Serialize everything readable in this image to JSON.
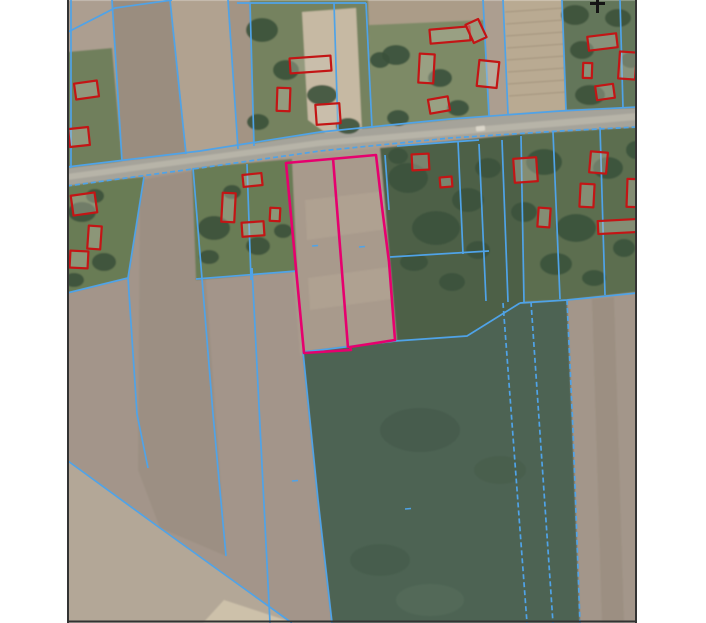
{
  "app": {
    "name": "cadastral-aerial-map-view"
  },
  "canvas": {
    "width": 706,
    "height": 623,
    "margin_color": "#ffffff"
  },
  "map": {
    "x": 67,
    "y": 0,
    "width": 570,
    "height": 623,
    "border_color": "#333333",
    "border_width": 2,
    "base_fill": "#ac9e90"
  },
  "legend_colors": {
    "parcel_boundary": "#4fa3e8",
    "building_outline": "#c31515",
    "selected_parcel": "#e6006e",
    "road": "#a5a39a",
    "north_mark": "#141414"
  },
  "fields": [
    {
      "name": "upper-left-green",
      "points": "67,52 112,48 122,161 67,170",
      "fill": "#6f7f5c"
    },
    {
      "name": "upper-strip-1",
      "points": "112,0 170,0 186,154 122,161",
      "fill": "#9a8d7f"
    },
    {
      "name": "upper-strip-2",
      "points": "170,0 228,0 238,149 186,154",
      "fill": "#b1a290"
    },
    {
      "name": "upper-strip-3",
      "points": "228,0 250,0 254,147 238,149",
      "fill": "#a39484"
    },
    {
      "name": "farmstead-1-green",
      "points": "250,0 368,0 372,128 254,147",
      "fill": "#75825f"
    },
    {
      "name": "farmstead-1-yard",
      "points": "302,12 356,8 362,132 330,136 308,120",
      "fill": "#c6b9a3"
    },
    {
      "name": "farmstead-2-green",
      "points": "368,0 483,0 489,116 372,128",
      "fill": "#7d8a66"
    },
    {
      "name": "farmstead-2-top-strip",
      "points": "368,0 483,0 484,20 369,25",
      "fill": "#ab9c88"
    },
    {
      "name": "rowed-garden",
      "points": "503,0 562,0 566,110 508,114",
      "fill": "#b9aa92"
    },
    {
      "name": "right-green-top",
      "points": "562,0 637,0 637,108 566,110",
      "fill": "#64765a"
    },
    {
      "name": "below-road-left-brown",
      "points": "67,186 300,156 335,623 67,623",
      "fill": "#a3958a"
    },
    {
      "name": "below-road-strip",
      "points": "140,180 198,170 226,556 160,528 138,470",
      "fill": "#9b8e81",
      "opacity": 0.85
    },
    {
      "name": "mid-brown-field",
      "points": "283,158 400,146 406,345 300,356",
      "fill": "#a89a8c"
    },
    {
      "name": "mid-field-strip-1",
      "points": "305,200 394,190 395,228 307,240",
      "fill": "#b5a795",
      "opacity": 0.55
    },
    {
      "name": "mid-field-strip-2",
      "points": "308,278 397,266 399,298 310,310",
      "fill": "#b5a795",
      "opacity": 0.5
    },
    {
      "name": "homestead-a-green",
      "points": "67,184 144,177 128,278 67,293",
      "fill": "#697b55"
    },
    {
      "name": "homestead-b-green",
      "points": "192,168 292,159 297,271 196,280",
      "fill": "#697b55"
    },
    {
      "name": "gardens-dark-green",
      "points": "380,148 522,134 524,302 468,336 397,342",
      "fill": "#4e6147"
    },
    {
      "name": "right-roadside-green",
      "points": "522,134 637,127 637,292 567,300 524,302",
      "fill": "#5b6e50"
    },
    {
      "name": "big-green-field",
      "points": "303,352 395,341 467,336 520,303 567,300 573,430 580,623 332,623 318,500",
      "fill": "#4d6353"
    },
    {
      "name": "right-brown-field",
      "points": "567,300 637,293 637,623 580,623 572,420",
      "fill": "#a3968a"
    },
    {
      "name": "right-brown-strip",
      "points": "592,299 614,297 624,623 602,623",
      "fill": "#998c7f",
      "opacity": 0.7
    },
    {
      "name": "bottom-left-tan-field",
      "points": "67,460 160,528 292,623 67,623",
      "fill": "#b3a797"
    },
    {
      "name": "bottom-light-wedge",
      "points": "224,600 294,623 203,623",
      "fill": "#cdc1aa"
    }
  ],
  "road": {
    "points": "67,168 200,152 320,133 450,120 560,112 637,108 637,127 560,131 450,138 320,151 200,168 67,186",
    "fill": "#a5a39a",
    "stripe_points": "67,174 320,140 637,113 637,120 320,146 67,180",
    "stripe_fill": "#c6c3b5",
    "stripe_opacity": 0.55
  },
  "tree_patches": [
    {
      "cx": 262,
      "cy": 30,
      "rx": 16,
      "ry": 12
    },
    {
      "cx": 286,
      "cy": 70,
      "rx": 13,
      "ry": 10
    },
    {
      "cx": 322,
      "cy": 95,
      "rx": 15,
      "ry": 10
    },
    {
      "cx": 348,
      "cy": 126,
      "rx": 12,
      "ry": 8
    },
    {
      "cx": 258,
      "cy": 122,
      "rx": 11,
      "ry": 8
    },
    {
      "cx": 380,
      "cy": 60,
      "rx": 10,
      "ry": 8
    },
    {
      "cx": 396,
      "cy": 55,
      "rx": 14,
      "ry": 10
    },
    {
      "cx": 440,
      "cy": 78,
      "rx": 12,
      "ry": 9
    },
    {
      "cx": 458,
      "cy": 108,
      "rx": 11,
      "ry": 8
    },
    {
      "cx": 398,
      "cy": 118,
      "rx": 11,
      "ry": 8
    },
    {
      "cx": 575,
      "cy": 15,
      "rx": 14,
      "ry": 10
    },
    {
      "cx": 590,
      "cy": 95,
      "rx": 15,
      "ry": 10
    },
    {
      "cx": 618,
      "cy": 18,
      "rx": 13,
      "ry": 9
    },
    {
      "cx": 631,
      "cy": 60,
      "rx": 10,
      "ry": 8
    },
    {
      "cx": 582,
      "cy": 50,
      "rx": 12,
      "ry": 9
    },
    {
      "cx": 82,
      "cy": 212,
      "rx": 14,
      "ry": 10
    },
    {
      "cx": 104,
      "cy": 262,
      "rx": 12,
      "ry": 9
    },
    {
      "cx": 74,
      "cy": 280,
      "rx": 10,
      "ry": 7
    },
    {
      "cx": 95,
      "cy": 196,
      "rx": 9,
      "ry": 7
    },
    {
      "cx": 214,
      "cy": 228,
      "rx": 16,
      "ry": 12
    },
    {
      "cx": 258,
      "cy": 246,
      "rx": 12,
      "ry": 9
    },
    {
      "cx": 232,
      "cy": 192,
      "rx": 9,
      "ry": 7
    },
    {
      "cx": 283,
      "cy": 231,
      "rx": 9,
      "ry": 7
    },
    {
      "cx": 209,
      "cy": 257,
      "rx": 10,
      "ry": 7
    },
    {
      "cx": 408,
      "cy": 178,
      "rx": 20,
      "ry": 15
    },
    {
      "cx": 436,
      "cy": 228,
      "rx": 24,
      "ry": 17
    },
    {
      "cx": 468,
      "cy": 200,
      "rx": 16,
      "ry": 12
    },
    {
      "cx": 414,
      "cy": 262,
      "rx": 14,
      "ry": 9
    },
    {
      "cx": 452,
      "cy": 282,
      "rx": 13,
      "ry": 9
    },
    {
      "cx": 488,
      "cy": 168,
      "rx": 13,
      "ry": 10
    },
    {
      "cx": 478,
      "cy": 250,
      "rx": 12,
      "ry": 9
    },
    {
      "cx": 398,
      "cy": 156,
      "rx": 10,
      "ry": 8
    },
    {
      "cx": 544,
      "cy": 162,
      "rx": 18,
      "ry": 13
    },
    {
      "cx": 576,
      "cy": 228,
      "rx": 20,
      "ry": 14
    },
    {
      "cx": 608,
      "cy": 168,
      "rx": 15,
      "ry": 11
    },
    {
      "cx": 556,
      "cy": 264,
      "rx": 16,
      "ry": 11
    },
    {
      "cx": 624,
      "cy": 248,
      "rx": 11,
      "ry": 9
    },
    {
      "cx": 524,
      "cy": 212,
      "rx": 13,
      "ry": 10
    },
    {
      "cx": 594,
      "cy": 278,
      "rx": 12,
      "ry": 8
    },
    {
      "cx": 636,
      "cy": 150,
      "rx": 10,
      "ry": 9
    },
    {
      "cx": 420,
      "cy": 430,
      "rx": 40,
      "ry": 22,
      "fill": "#42584a",
      "opacity": 0.55
    },
    {
      "cx": 380,
      "cy": 560,
      "rx": 30,
      "ry": 16,
      "fill": "#42584a",
      "opacity": 0.5
    },
    {
      "cx": 500,
      "cy": 470,
      "rx": 26,
      "ry": 14,
      "fill": "#42584a",
      "opacity": 0.45
    },
    {
      "cx": 430,
      "cy": 600,
      "rx": 34,
      "ry": 16,
      "fill": "#5a7060",
      "opacity": 0.5
    }
  ],
  "texture_lines": {
    "color": "#93846f",
    "width": 1,
    "opacity": 0.6,
    "lines": [
      "505,12 563,8",
      "506,24 563,20",
      "506,36 564,32",
      "507,48 564,44",
      "507,60 565,56",
      "508,72 565,68",
      "508,84 566,80",
      "509,96 566,92"
    ]
  },
  "parcel_lines": [
    {
      "points": "68,32 115,8 172,0"
    },
    {
      "points": "71,0 71,168"
    },
    {
      "points": "112,0 122,161"
    },
    {
      "points": "170,0 186,154"
    },
    {
      "points": "228,0 238,149"
    },
    {
      "points": "237,3 366,3"
    },
    {
      "points": "250,3 254,146"
    },
    {
      "points": "334,3 338,130"
    },
    {
      "points": "366,3 372,128"
    },
    {
      "points": "483,0 489,116"
    },
    {
      "points": "503,0 508,114"
    },
    {
      "points": "562,0 566,110"
    },
    {
      "points": "620,0 623,108"
    },
    {
      "points": "67,167 200,151 320,132 450,119 560,111 637,107"
    },
    {
      "points": "67,186 200,168 320,151 450,138 560,131 637,127",
      "dashed": true
    },
    {
      "points": "144,177 128,278"
    },
    {
      "points": "128,278 67,293"
    },
    {
      "points": "128,278 137,414 148,468"
    },
    {
      "points": "193,168 213,414 226,556"
    },
    {
      "points": "247,164 251,280"
    },
    {
      "points": "196,279 297,271"
    },
    {
      "points": "252,268 270,623"
    },
    {
      "points": "397,146 479,140"
    },
    {
      "points": "458,141 463,254"
    },
    {
      "points": "479,144 486,301"
    },
    {
      "points": "502,140 508,302"
    },
    {
      "points": "521,136 524,302"
    },
    {
      "points": "390,257 489,251"
    },
    {
      "points": "553,132 560,299"
    },
    {
      "points": "600,127 605,295"
    },
    {
      "points": "520,303 567,300 637,293"
    },
    {
      "points": "503,303 527,623",
      "dashed": true
    },
    {
      "points": "531,302 553,623",
      "dashed": true
    },
    {
      "points": "303,352 318,500 332,623"
    },
    {
      "points": "303,352 395,341 467,336 520,303"
    },
    {
      "points": "68,461 160,528 292,623"
    },
    {
      "points": "567,300 573,430 580,623",
      "dashed": true
    },
    {
      "points": "385,155 389,210"
    }
  ],
  "tick_marks": [
    [
      315,
      246
    ],
    [
      362,
      247
    ],
    [
      408,
      509
    ],
    [
      295,
      481
    ]
  ],
  "buildings": [
    {
      "x": 75,
      "y": 82,
      "w": 23,
      "h": 16,
      "r": -8
    },
    {
      "x": 69,
      "y": 128,
      "w": 20,
      "h": 18,
      "r": -6
    },
    {
      "x": 290,
      "y": 57,
      "w": 41,
      "h": 15,
      "r": -4
    },
    {
      "x": 277,
      "y": 88,
      "w": 13,
      "h": 23,
      "r": 2
    },
    {
      "x": 316,
      "y": 104,
      "w": 24,
      "h": 20,
      "r": -4
    },
    {
      "x": 430,
      "y": 28,
      "w": 40,
      "h": 14,
      "r": -5
    },
    {
      "x": 419,
      "y": 54,
      "w": 15,
      "h": 29,
      "r": 3
    },
    {
      "x": 429,
      "y": 98,
      "w": 20,
      "h": 14,
      "r": -10
    },
    {
      "x": 469,
      "y": 21,
      "w": 14,
      "h": 20,
      "r": -25
    },
    {
      "x": 478,
      "y": 61,
      "w": 20,
      "h": 26,
      "r": 6
    },
    {
      "x": 588,
      "y": 35,
      "w": 29,
      "h": 14,
      "r": -7
    },
    {
      "x": 619,
      "y": 52,
      "w": 17,
      "h": 27,
      "r": 4
    },
    {
      "x": 583,
      "y": 63,
      "w": 9,
      "h": 15,
      "r": 2
    },
    {
      "x": 596,
      "y": 85,
      "w": 18,
      "h": 14,
      "r": -8
    },
    {
      "x": 72,
      "y": 194,
      "w": 24,
      "h": 20,
      "r": -8
    },
    {
      "x": 88,
      "y": 226,
      "w": 13,
      "h": 23,
      "r": 4
    },
    {
      "x": 70,
      "y": 251,
      "w": 18,
      "h": 17,
      "r": 3
    },
    {
      "x": 243,
      "y": 174,
      "w": 19,
      "h": 12,
      "r": -6
    },
    {
      "x": 222,
      "y": 193,
      "w": 13,
      "h": 29,
      "r": 3
    },
    {
      "x": 270,
      "y": 208,
      "w": 10,
      "h": 13,
      "r": 3
    },
    {
      "x": 242,
      "y": 222,
      "w": 22,
      "h": 14,
      "r": -4
    },
    {
      "x": 412,
      "y": 154,
      "w": 17,
      "h": 16,
      "r": -3
    },
    {
      "x": 440,
      "y": 177,
      "w": 12,
      "h": 10,
      "r": -5
    },
    {
      "x": 514,
      "y": 158,
      "w": 23,
      "h": 24,
      "r": -4
    },
    {
      "x": 590,
      "y": 152,
      "w": 17,
      "h": 21,
      "r": 5
    },
    {
      "x": 580,
      "y": 184,
      "w": 14,
      "h": 23,
      "r": 3
    },
    {
      "x": 627,
      "y": 179,
      "w": 11,
      "h": 28,
      "r": 2
    },
    {
      "x": 538,
      "y": 208,
      "w": 12,
      "h": 19,
      "r": 4
    },
    {
      "x": 598,
      "y": 220,
      "w": 40,
      "h": 13,
      "r": -3
    }
  ],
  "building_style": {
    "stroke_width": 2.2,
    "roof_fill": "#cfc8bb",
    "roof_opacity": 0.35
  },
  "highlight_parcel": {
    "outline": "286,163 376,155 382,207 389,262 395,340 350,347 351,350 304,353",
    "divider": "333,158 348,348",
    "color": "#e6006e",
    "width": 2.6
  },
  "vehicle": {
    "x": 476,
    "y": 126,
    "w": 9,
    "h": 5,
    "r": -6,
    "fill": "#dcd7ca"
  },
  "north_mark": {
    "lines": [
      [
        590,
        3.5,
        605,
        3.5
      ],
      [
        597.5,
        0,
        597.5,
        13
      ]
    ],
    "width": 3
  },
  "line_style": {
    "width": 1.7,
    "dash": "5 3"
  }
}
